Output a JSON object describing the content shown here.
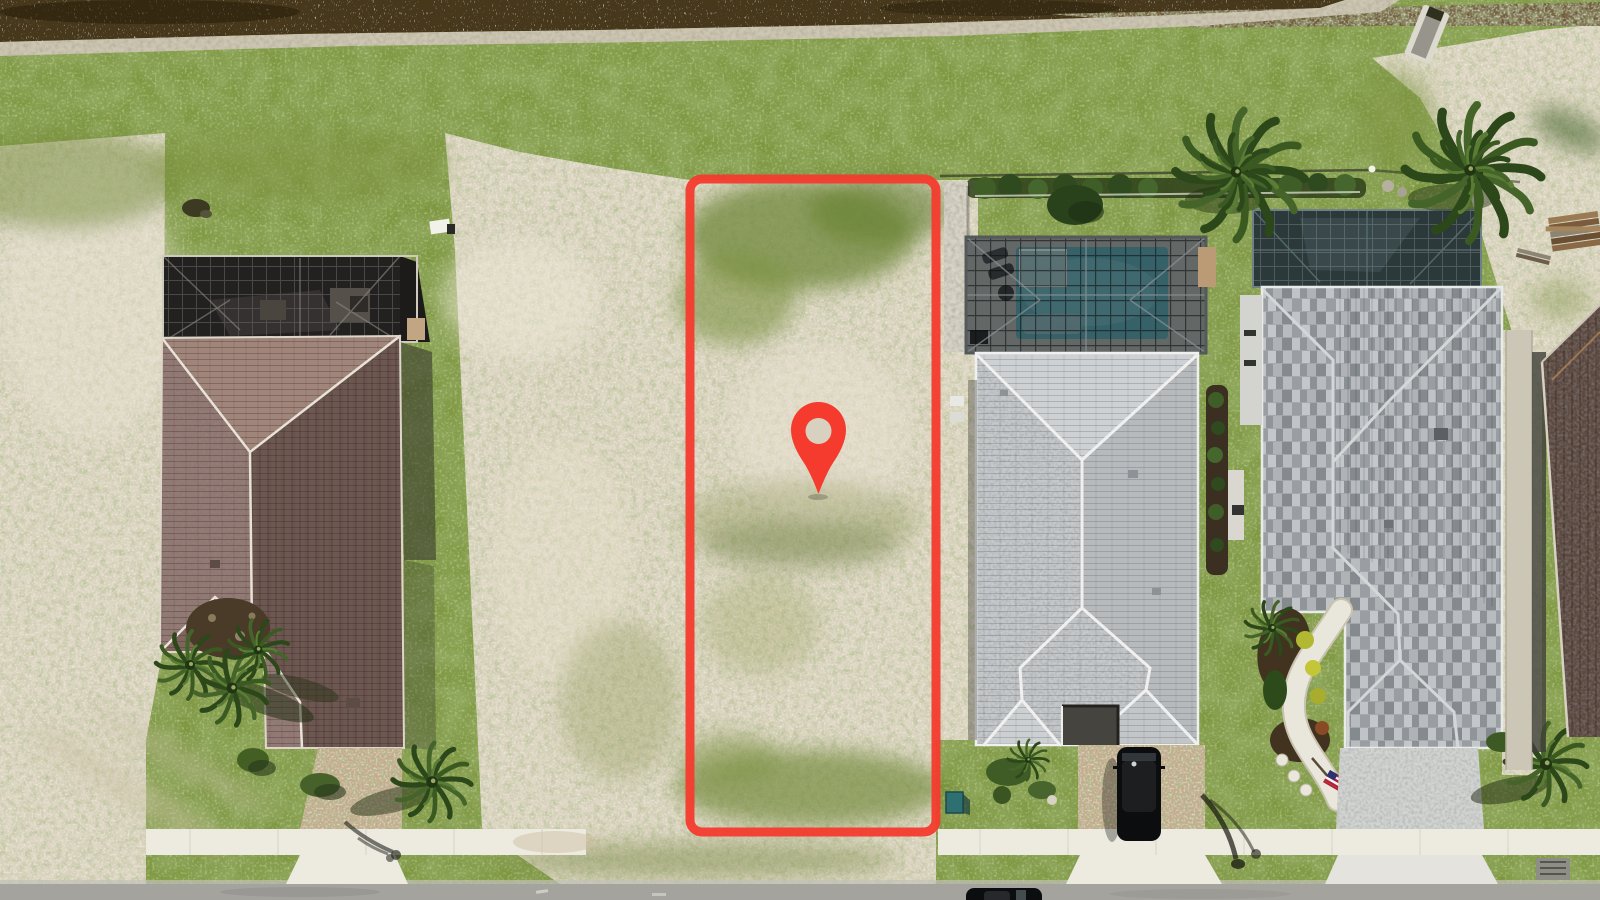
{
  "meta": {
    "title": "Aerial drone photo of a vacant residential lot for sale",
    "image_type": "top-down aerial photograph",
    "description": "Top-down drone photo of a Florida-style street. A vacant sandy lot in the center is outlined with a red property-boundary rectangle and marked with a red map pin. A brown-tile-roof house with a dark screened lanai sits to the left across empty sandy land. To the right are two gray-roofed homes, the nearer one with a screened swimming-pool enclosure, paver driveway and black SUV, the farther one with a stone-patterned roof, curved walkway, garden and American flag. A canal with sparkling water runs along the top edge; a road with white sidewalk runs along the bottom."
  },
  "palette": {
    "marker_red": "#f43b2e",
    "water": "#46391a",
    "shore_rocks": "#cdc6b2",
    "dirt_bank": "#6f5c33",
    "grass": "#7d9740",
    "sand": "#ddd5c2",
    "road": "#a5a39e",
    "sidewalk": "#edebe0",
    "pool_water": "#4d96a0",
    "spa": "#88b0b4",
    "pool_deck": "#99a09d",
    "roof_left_house": "#927770",
    "roof_house1": "#c6c9cb",
    "roof_house2_base": "#a9aeb1",
    "roof_far_house": "#5c463a",
    "screen_cage": "#232120",
    "cage2_glass": "#2c393b",
    "paver_tan": "#c2ab8c",
    "paver_gray": "#d2d4d2",
    "mulch": "#4a3a28",
    "palm_dark": "#2c4719",
    "palm_light": "#44642a",
    "suv_black": "#0c0d0e",
    "utility_teal": "#2e6f72"
  },
  "scene": {
    "marker": {
      "type": "map-pin",
      "color": "#f43b2e",
      "outline": "red rounded-rectangle lot boundary"
    },
    "elements": [
      {
        "name": "canal-water",
        "description": "dark brown canal water with white sun sparkle along the top edge"
      },
      {
        "name": "rock-shoreline",
        "description": "pale riprap rock band along the canal bank"
      },
      {
        "name": "grass-bank",
        "description": "green mowed grass strip between canal and properties"
      },
      {
        "name": "vacant-sand-left",
        "description": "large sandy weed-speckled vacant land on the left"
      },
      {
        "name": "outlined-lot",
        "description": "vacant sandy lot outlined in red with map pin marker"
      },
      {
        "name": "location-pin",
        "description": "red map pin with hole in the middle of the lot"
      },
      {
        "name": "left-house",
        "description": "house with mauve-brown hip tile roof and dark screened lanai cage"
      },
      {
        "name": "left-house-driveway",
        "description": "tan paver driveway with white concrete apron"
      },
      {
        "name": "house1",
        "description": "light gray shingle hip roof home right of the lot"
      },
      {
        "name": "pool-enclosure",
        "description": "dark screened cage over teal swimming pool, spa and gray deck"
      },
      {
        "name": "house1-driveway",
        "description": "tan paver driveway with parked black SUV"
      },
      {
        "name": "house2",
        "description": "home with variegated gray stone-pattern roof, curved white walkway, garden and flag"
      },
      {
        "name": "house2-pool-cage",
        "description": "dark glass screened enclosure behind house2"
      },
      {
        "name": "american-flag",
        "description": "small US flag on angled pole by front walkway"
      },
      {
        "name": "far-right-house",
        "description": "dark brown roof of neighboring house at right edge"
      },
      {
        "name": "lumber-pile",
        "description": "stacked construction boards on sand, upper right"
      },
      {
        "name": "drainage-culvert",
        "description": "white concrete drainage chute into canal, top right"
      },
      {
        "name": "hedge-row",
        "description": "shrub and fence line behind the right-side homes"
      },
      {
        "name": "palm-trees",
        "description": "several palms: two large behind house1/house2, clusters by left house, driveway palms"
      },
      {
        "name": "street-road",
        "description": "gray asphalt road along bottom edge"
      },
      {
        "name": "sidewalk",
        "description": "white concrete sidewalk segments in front of built homes"
      },
      {
        "name": "parked-car",
        "description": "dark car on the road at bottom center-right"
      },
      {
        "name": "utility-box",
        "description": "small teal utility box near lot corner"
      },
      {
        "name": "storm-drain",
        "description": "gray storm drain grate at bottom right"
      },
      {
        "name": "street-light-shadows",
        "description": "thin curved shadows of street lamps on sidewalk"
      }
    ]
  }
}
